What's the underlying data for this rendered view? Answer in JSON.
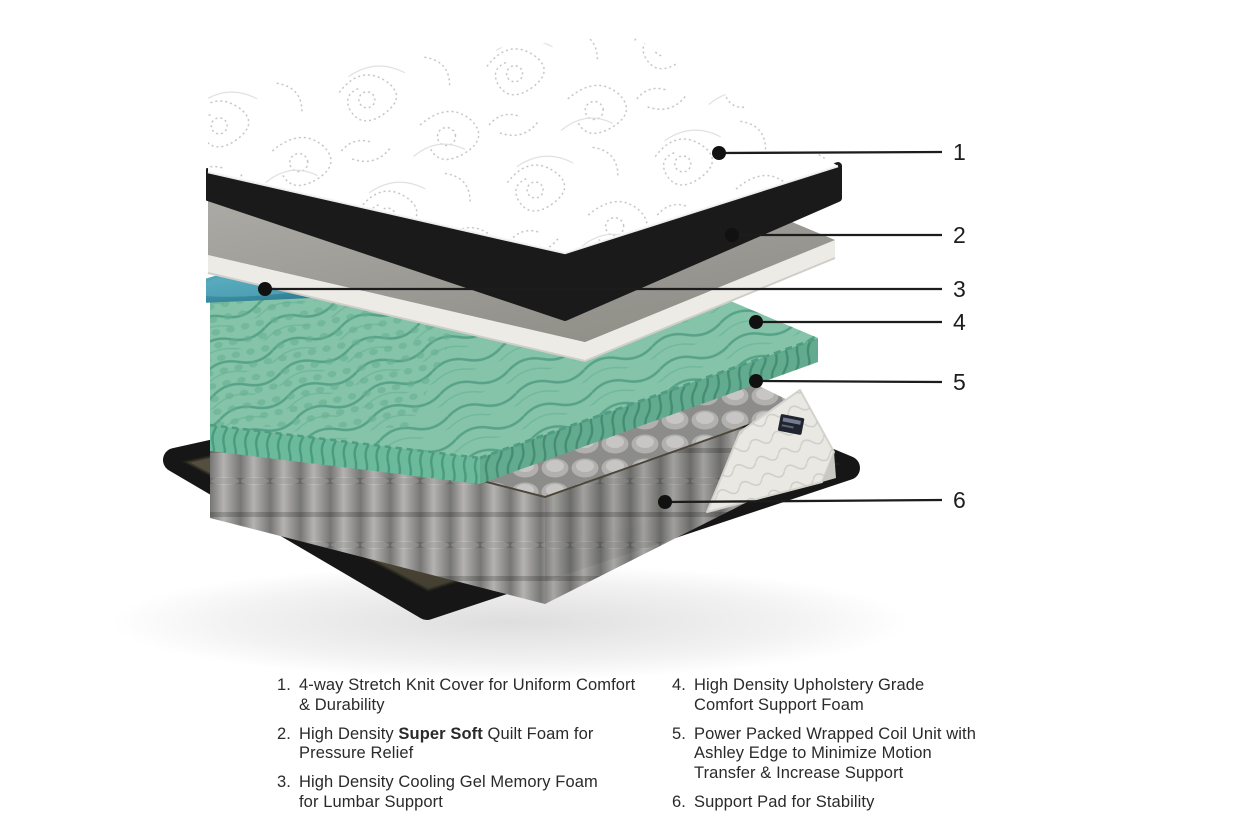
{
  "diagram": {
    "title": "mattress-cutaway-exploded-view",
    "callouts": [
      {
        "number": "1"
      },
      {
        "number": "2"
      },
      {
        "number": "3"
      },
      {
        "number": "4"
      },
      {
        "number": "5"
      },
      {
        "number": "6"
      }
    ],
    "legend": {
      "left": [
        {
          "num": "1.",
          "text": "4-way Stretch Knit Cover for Uniform Comfort\n& Durability"
        },
        {
          "num": "2.",
          "prefix": "High Density ",
          "bold": "Super Soft",
          "suffix": " Quilt Foam for\nPressure Relief"
        },
        {
          "num": "3.",
          "text": "High Density Cooling Gel Memory Foam\nfor Lumbar Support"
        }
      ],
      "right": [
        {
          "num": "4.",
          "text": "High Density Upholstery Grade\nComfort Support Foam"
        },
        {
          "num": "5.",
          "text": "Power Packed Wrapped Coil Unit with\nAshley Edge to Minimize Motion\nTransfer & Increase Support"
        },
        {
          "num": "6.",
          "text": "Support Pad for Stability"
        }
      ]
    },
    "colors": {
      "background": "#ffffff",
      "mattress_band_black": "#1a1a1a",
      "cover_floral_gray": "#c6c6c6",
      "foam_slab_gray": "#aaa9a5",
      "slab_edge_white": "#eceBe6",
      "cooling_gel_teal": "#3e8fa4",
      "memory_foam_green": "#85c4a8",
      "memory_foam_green_dark": "#58a58a",
      "coil_gray": "#a9a8a6",
      "edge_foam_white": "#e9e8e3",
      "support_pad_olive": "#4c4737",
      "base_black": "#161616",
      "callout_line": "#1c1c1c",
      "legend_text": "#2a2a2a"
    }
  }
}
